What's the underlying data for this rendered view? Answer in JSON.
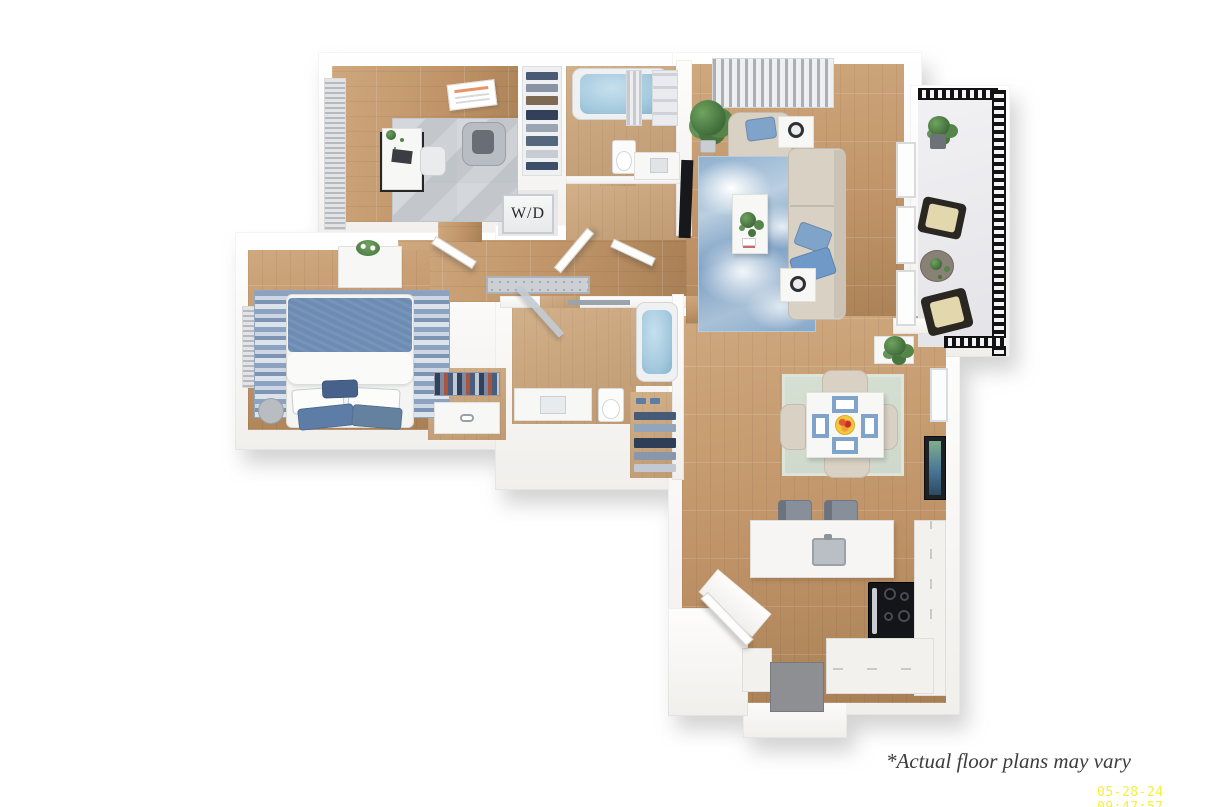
{
  "watermark": {
    "disclaimer": "*Actual floor plans may vary",
    "timestamp": "05-28-24 09:47:57"
  },
  "labels": {
    "washer_dryer": "W/D"
  },
  "palette": {
    "wall_hi": "#ffffff",
    "wall_lo": "#f1efec",
    "wood_hi": "#cfa87e",
    "wood_mid": "#c09468",
    "wood_lo": "#a87f55",
    "wood_light_hi": "#d2b089",
    "wood_light_lo": "#bf9a72",
    "water_blue": "#a5cade",
    "accent_blue": "#7fa3c9",
    "pillow_blue": "#5d7ca6",
    "sofa_beige": "#d8d1c4",
    "rug_gray": "#ccd0d4",
    "rug_sage": "#ced8cb",
    "rug_stripe_a": "#8ba2c0",
    "rug_stripe_b": "#cdd6e2",
    "balcony_black": "#121214",
    "stool_gray": "#87909a",
    "mat_gray": "#8d8f93",
    "stove_black": "#141518",
    "ink": "#3c3c3c",
    "stamp_yellow": "#f6ef3e"
  },
  "rooms": [
    "office",
    "hall-closet",
    "bathroom-1",
    "washer-dryer-closet",
    "hallway",
    "primary-bedroom",
    "walk-in-closet",
    "bathroom-2",
    "linen-closet",
    "living-room",
    "dining-area",
    "kitchen",
    "entry",
    "balcony"
  ]
}
